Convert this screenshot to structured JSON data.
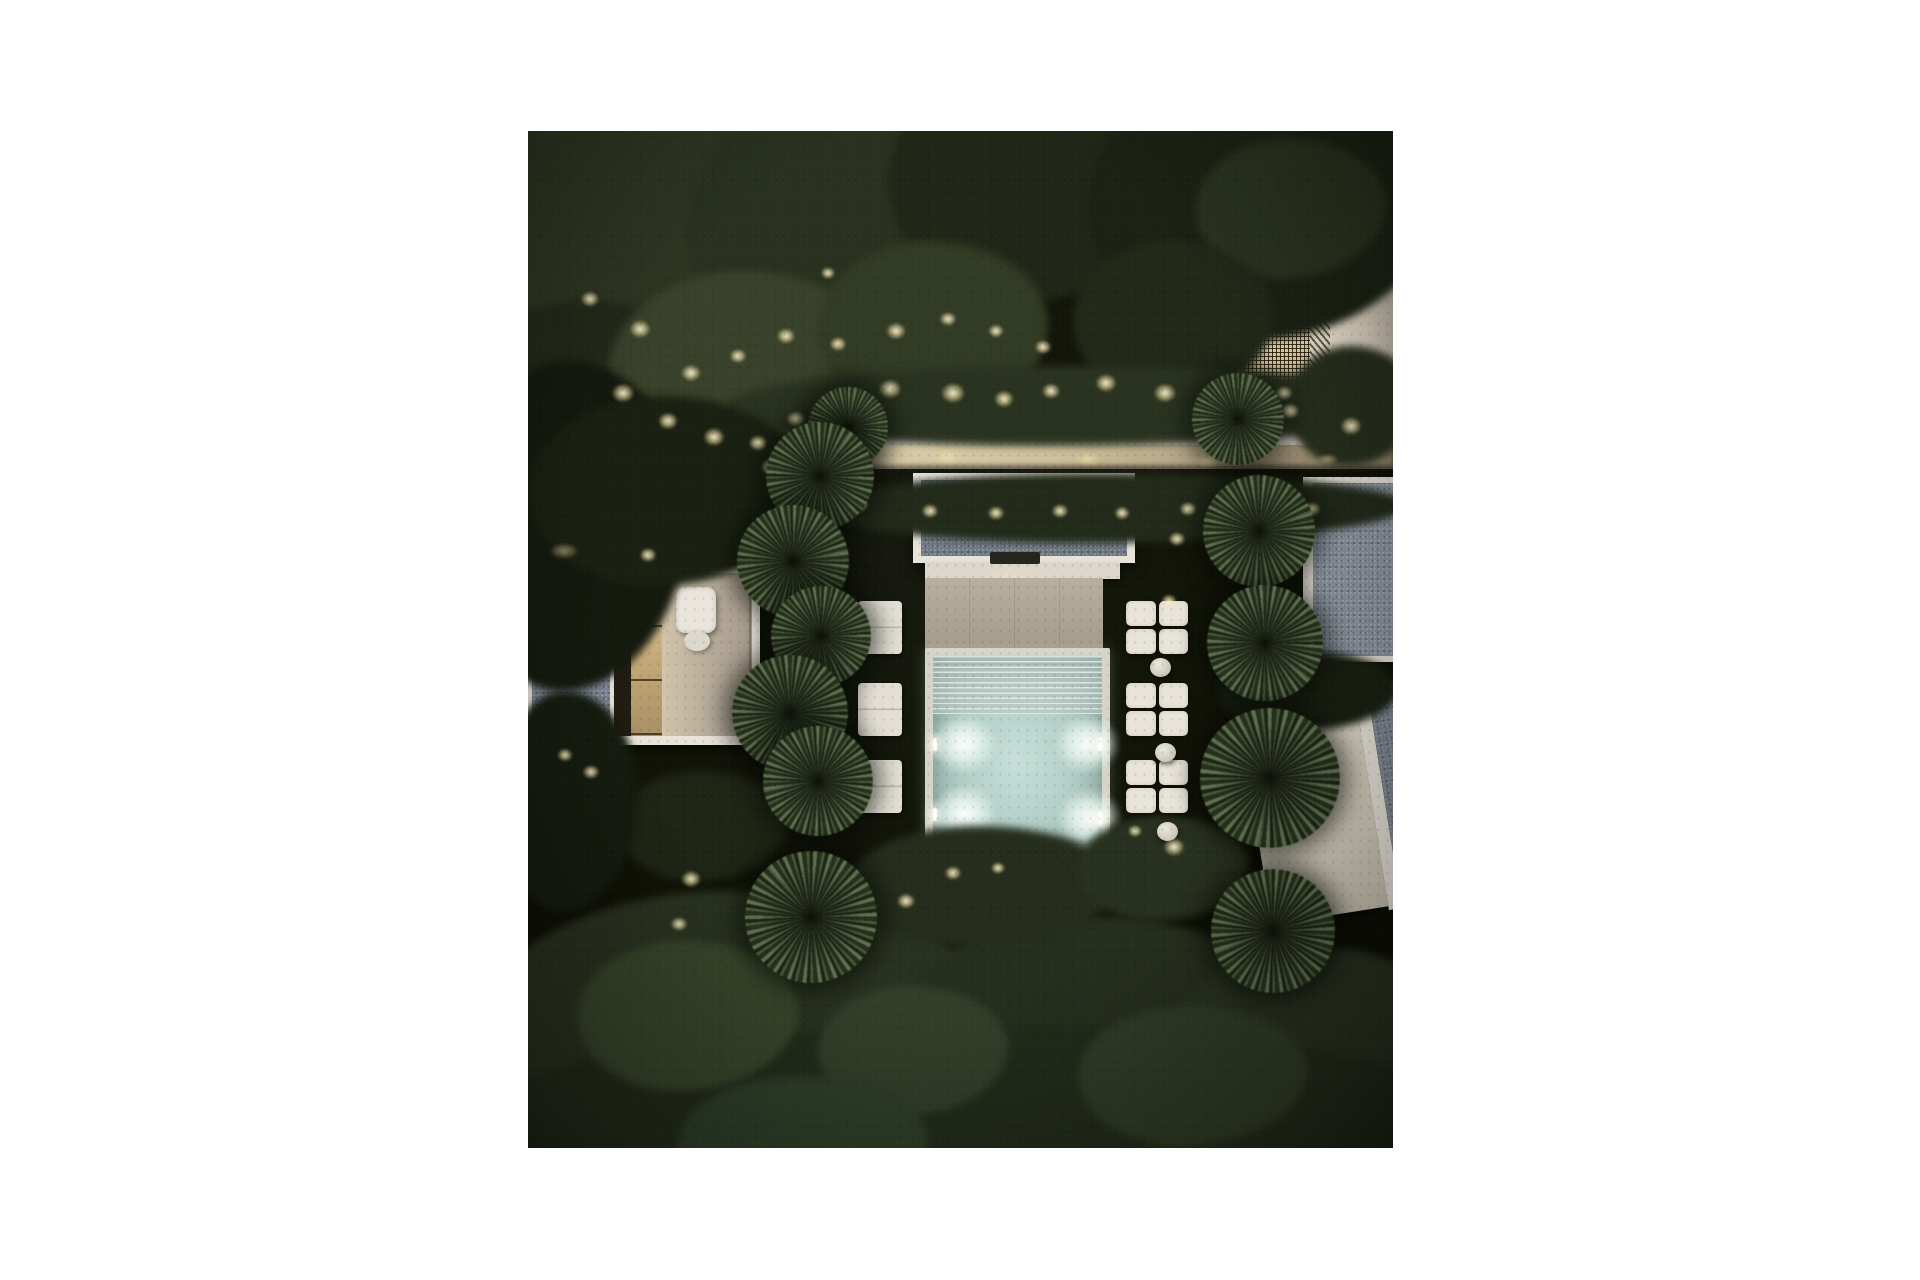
{
  "scene": {
    "description": "Night-time aerial 3D rendering of a modern villa garden: central pavilion with gravel roof, glowing turquoise plunge pool with four underwater lights, beige terrace, white daybeds with round side tables, columns of yucca trees, dense dark tree canopies with warm garden spike lights, a lit walkway and stair, a left villa with pergola and roof terrace, a backlit lattice-screen building top-right and a rotated villa bottom-right",
    "palette": {
      "page_background": "#ffffff",
      "night_ground": "#101207",
      "tree_mid": "#2f3722",
      "tree_dark": "#1c2315",
      "tree_soft": "#3a432b",
      "warm_light": "#f3e6b4",
      "white_structure": "#e8e4da",
      "gravel_roof": "#7c8591",
      "terrace_beige": "#b2a897",
      "cream_wall": "#d9d2c3",
      "pool_water": "#b4cfc8",
      "pool_orb": "#eef7ef",
      "lattice_glow": "#e9d49b"
    },
    "photo_frame": {
      "left": 528,
      "top": 131,
      "width": 865,
      "height": 1017
    },
    "trees": [
      [
        -70,
        -80,
        500,
        430,
        "#2f3722"
      ],
      [
        -90,
        170,
        310,
        270,
        "#232b1a"
      ],
      [
        160,
        -50,
        340,
        310,
        "#2a331f"
      ],
      [
        360,
        -70,
        300,
        240,
        "#212818"
      ],
      [
        80,
        140,
        280,
        210,
        "#3a432b"
      ],
      [
        290,
        110,
        230,
        180,
        "#333c25"
      ],
      [
        560,
        -60,
        350,
        270,
        "#1c2315"
      ],
      [
        668,
        8,
        190,
        140,
        "#2b341f"
      ],
      [
        545,
        110,
        200,
        160,
        "#222a19"
      ],
      [
        200,
        235,
        700,
        80,
        "#2b3420"
      ],
      [
        760,
        215,
        130,
        120,
        "#28301d"
      ],
      [
        290,
        342,
        590,
        70,
        "#232b1a"
      ],
      [
        -70,
        230,
        230,
        330,
        "#151a0f"
      ],
      [
        0,
        265,
        280,
        190,
        "#1b2112"
      ],
      [
        90,
        640,
        170,
        110,
        "#1f2615"
      ],
      [
        -30,
        560,
        140,
        220,
        "#161c10"
      ],
      [
        690,
        520,
        180,
        80,
        "#1a2012"
      ],
      [
        -70,
        760,
        560,
        340,
        "#2a3320"
      ],
      [
        350,
        785,
        440,
        290,
        "#27301e"
      ],
      [
        630,
        815,
        320,
        260,
        "#2a3421"
      ],
      [
        -50,
        895,
        1000,
        190,
        "#232d1b"
      ],
      [
        50,
        810,
        220,
        150,
        "#39462a"
      ],
      [
        290,
        855,
        190,
        130,
        "#35412a"
      ],
      [
        550,
        875,
        230,
        140,
        "#323d26"
      ],
      [
        150,
        945,
        250,
        140,
        "#30402a"
      ],
      [
        320,
        695,
        270,
        120,
        "#262e1c"
      ],
      [
        550,
        685,
        170,
        105,
        "#293220"
      ]
    ],
    "glows": [
      [
        95,
        262,
        16,
        "spot"
      ],
      [
        140,
        290,
        14,
        "spot"
      ],
      [
        186,
        306,
        15,
        "spot"
      ],
      [
        230,
        312,
        13,
        "spot"
      ],
      [
        268,
        288,
        13,
        "spot"
      ],
      [
        318,
        268,
        14,
        "spot"
      ],
      [
        362,
        258,
        16,
        "spot"
      ],
      [
        425,
        262,
        17,
        "spot"
      ],
      [
        476,
        268,
        14,
        "spot"
      ],
      [
        523,
        260,
        13,
        "spot"
      ],
      [
        578,
        252,
        15,
        "spot"
      ],
      [
        637,
        262,
        16,
        "spot"
      ],
      [
        700,
        272,
        14,
        "spot"
      ],
      [
        762,
        280,
        13,
        "spot"
      ],
      [
        823,
        295,
        15,
        "spot"
      ],
      [
        62,
        168,
        13,
        "spot"
      ],
      [
        112,
        198,
        15,
        "spot"
      ],
      [
        163,
        242,
        14,
        "spot"
      ],
      [
        210,
        225,
        12,
        "spot"
      ],
      [
        258,
        205,
        13,
        "spot"
      ],
      [
        310,
        213,
        12,
        "spot"
      ],
      [
        368,
        200,
        14,
        "spot"
      ],
      [
        300,
        142,
        10,
        "spot"
      ],
      [
        420,
        188,
        12,
        "spot"
      ],
      [
        468,
        200,
        11,
        "spot"
      ],
      [
        515,
        216,
        12,
        "spot"
      ],
      [
        300,
        324,
        22,
        "wash"
      ],
      [
        420,
        326,
        20,
        "wash"
      ],
      [
        560,
        328,
        18,
        "wash"
      ],
      [
        680,
        330,
        16,
        "wash"
      ],
      [
        800,
        328,
        14,
        "wash"
      ],
      [
        332,
        374,
        12,
        "spot"
      ],
      [
        402,
        380,
        12,
        "spot"
      ],
      [
        468,
        382,
        12,
        "spot"
      ],
      [
        532,
        380,
        12,
        "spot"
      ],
      [
        594,
        382,
        11,
        "spot"
      ],
      [
        660,
        378,
        12,
        "spot"
      ],
      [
        722,
        374,
        11,
        "spot"
      ],
      [
        784,
        378,
        12,
        "spot"
      ],
      [
        724,
        278,
        20,
        "wash"
      ],
      [
        756,
        262,
        12,
        "spot"
      ],
      [
        243,
        336,
        14,
        "spot"
      ],
      [
        36,
        420,
        20,
        "wash"
      ],
      [
        120,
        424,
        12,
        "spot"
      ],
      [
        649,
        408,
        12,
        "spot"
      ],
      [
        641,
        470,
        11,
        "spot"
      ],
      [
        704,
        436,
        12,
        "spot"
      ],
      [
        253,
        470,
        10,
        "spot"
      ],
      [
        37,
        624,
        11,
        "spot"
      ],
      [
        63,
        641,
        12,
        "spot"
      ],
      [
        163,
        748,
        14,
        "spot"
      ],
      [
        151,
        793,
        12,
        "spot"
      ],
      [
        378,
        770,
        13,
        "spot"
      ],
      [
        646,
        716,
        15,
        "spot"
      ],
      [
        607,
        700,
        10,
        "spot"
      ],
      [
        425,
        742,
        12,
        "spot"
      ],
      [
        470,
        737,
        10,
        "spot"
      ]
    ],
    "yuccas": [
      [
        320,
        296,
        40,
        10
      ],
      [
        292,
        345,
        54,
        35
      ],
      [
        265,
        430,
        56,
        80
      ],
      [
        293,
        505,
        50,
        140
      ],
      [
        262,
        582,
        58,
        200
      ],
      [
        290,
        650,
        55,
        260
      ],
      [
        283,
        786,
        66,
        320
      ],
      [
        710,
        288,
        46,
        15
      ],
      [
        731,
        400,
        56,
        70
      ],
      [
        737,
        512,
        58,
        130
      ],
      [
        742,
        647,
        70,
        190
      ],
      [
        745,
        800,
        62,
        250
      ]
    ],
    "daybeds": [
      [
        598,
        470
      ],
      [
        598,
        552
      ],
      [
        598,
        629
      ]
    ],
    "pads": [
      [
        330,
        470
      ],
      [
        330,
        552
      ],
      [
        330,
        629
      ]
    ],
    "tables": [
      [
        622,
        527,
        21
      ],
      [
        627,
        612,
        21
      ],
      [
        629,
        691,
        21
      ]
    ],
    "pool": {
      "orbs": [
        [
          31,
          88
        ],
        [
          154,
          88
        ],
        [
          31,
          158
        ],
        [
          156,
          162
        ]
      ],
      "rim_dots": [
        [
          0,
          82
        ],
        [
          0,
          152
        ],
        [
          165,
          82
        ],
        [
          165,
          156
        ]
      ]
    }
  }
}
